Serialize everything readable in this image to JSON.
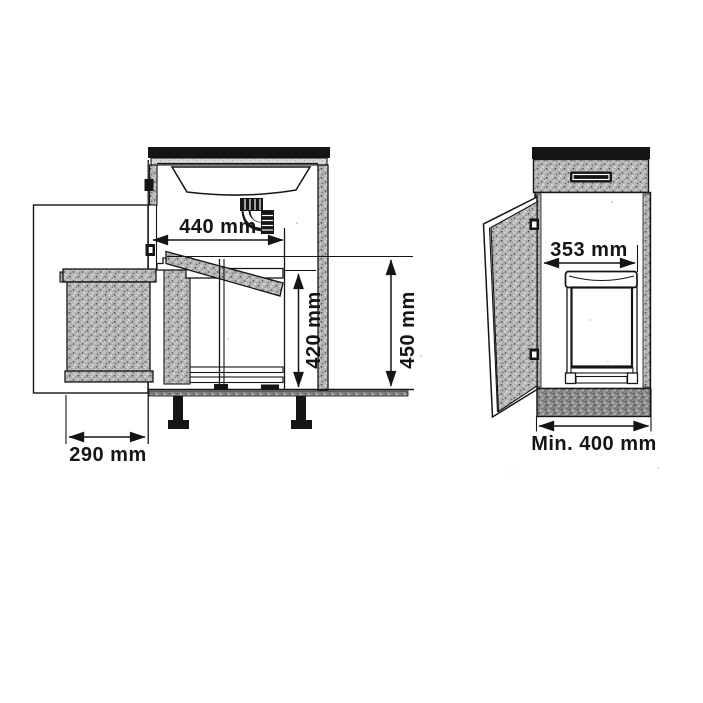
{
  "diagram": {
    "subject": "pull-out waste bin cabinet installation dimensions",
    "views": {
      "side": {
        "name": "side section view with bin pulled out",
        "dim_top_width": "440 mm",
        "dim_bin_height": "420 mm",
        "dim_interior_height": "450 mm",
        "dim_pullout_extension": "290 mm"
      },
      "front": {
        "name": "front view with door open",
        "dim_interior_width": "353 mm",
        "dim_min_cabinet_width": "Min. 400 mm"
      }
    },
    "colors": {
      "ink": "#151515",
      "speckle_mid": "#b6b6b6",
      "speckle_dark": "#9b9b9b",
      "speckle_light": "#d8d8d8",
      "paper": "#ffffff"
    }
  }
}
